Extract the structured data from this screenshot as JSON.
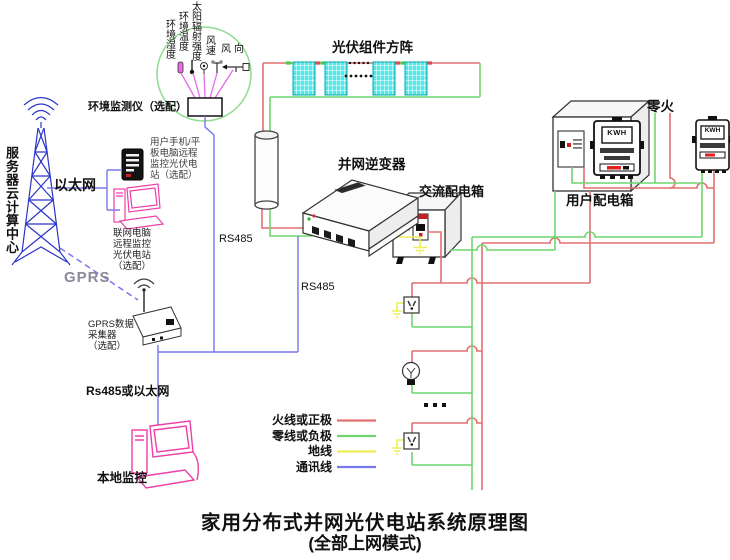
{
  "title": {
    "line1": "家用分布式并网光伏电站系统原理图",
    "line2": "(全部上网模式)"
  },
  "env": {
    "sensor_labels": [
      "环境湿度",
      "环境温度",
      "太阳辐射强度",
      "风速",
      "风向"
    ],
    "monitor_label": "环境监测仪（选配）"
  },
  "left": {
    "server_center": "服务器云计算中心",
    "ethernet": "以太网",
    "gprs": "GPRS",
    "phone_note": [
      "用户手机/平",
      "板电脑远程",
      "监控光伏电",
      "站（选配）"
    ],
    "pc_note": [
      "联网电脑",
      "远程监控",
      "光伏电站",
      "（选配）"
    ],
    "collector_note": [
      "GPRS数据",
      "采集器",
      "（选配）"
    ],
    "rs485_a": "RS485",
    "rs485_b": "RS485",
    "rs485_or_ethernet": "Rs485或以太网",
    "local_monitor": "本地监控"
  },
  "pv": {
    "array_title": "光伏组件方阵"
  },
  "devices": {
    "inverter": "并网逆变器",
    "ac_box": "交流配电箱",
    "user_box": "用户配电箱",
    "zero_fire": "零火",
    "meter1_display": "KWH",
    "meter2_display": "KWH"
  },
  "legend": {
    "items": [
      {
        "label": "火线或正极",
        "color": "#e07070"
      },
      {
        "label": "零线或负极",
        "color": "#6fd66f"
      },
      {
        "label": "地线",
        "color": "#eded55"
      },
      {
        "label": "通讯线",
        "color": "#7878ee"
      }
    ]
  },
  "colors": {
    "live": "#e07070",
    "neutral": "#6fd66f",
    "ground": "#eded55",
    "comm": "#7878ee",
    "sensor_line": "#e66ce6",
    "pink_device": "#ee3fa6",
    "tower_blue": "#2b35c8",
    "pv_cyan": "#56e8e8",
    "circle_green": "#8fdc8f"
  }
}
